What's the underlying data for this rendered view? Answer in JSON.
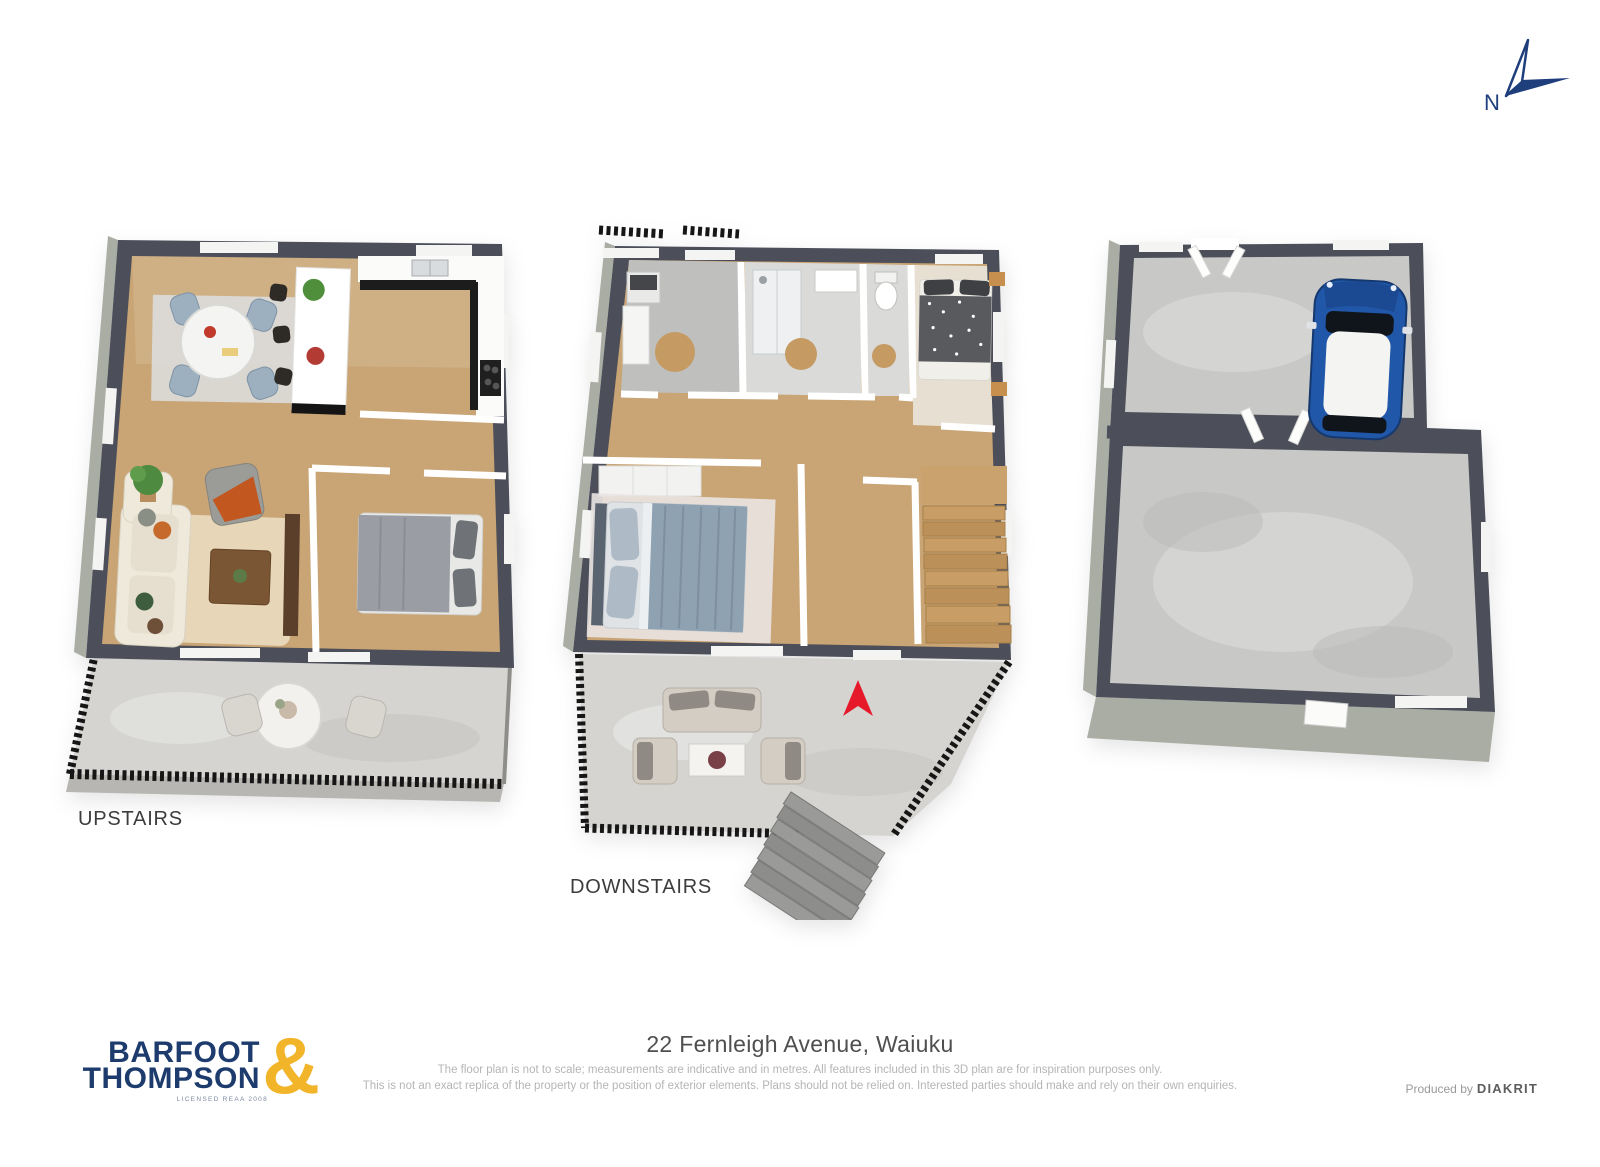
{
  "compass": {
    "north_label": "N",
    "color": "#1e3e7c"
  },
  "plans": {
    "upstairs": {
      "label": "UPSTAIRS"
    },
    "downstairs": {
      "label": "DOWNSTAIRS"
    },
    "garage": {
      "label": ""
    }
  },
  "footer": {
    "address": "22 Fernleigh Avenue, Waiuku",
    "disclaimer_line1": "The floor plan is not to scale; measurements are indicative and in metres. All features included in this 3D plan are for inspiration purposes only.",
    "disclaimer_line2": "This is not an exact replica of the property or the position of exterior elements. Plans should not be relied on. Interested parties should make and rely on their own enquiries.",
    "produced_by_label": "Produced by",
    "producer_name": "DIAKRIT"
  },
  "logo": {
    "line1": "BARFOOT",
    "line2": "THOMPSON",
    "ampersand": "&",
    "licensed_text": "LICENSED REAA 2008",
    "navy": "#1d3b6d",
    "gold": "#f2b52a"
  },
  "colors": {
    "wall_dark": "#4c4f5a",
    "wall_side": "#a9ada3",
    "wood_floor": "#c9a474",
    "concrete_floor": "#c8c8c6",
    "deck_floor": "#d5d4d1",
    "entrance_arrow": "#e6192b",
    "car_blue": "#2157a8"
  }
}
